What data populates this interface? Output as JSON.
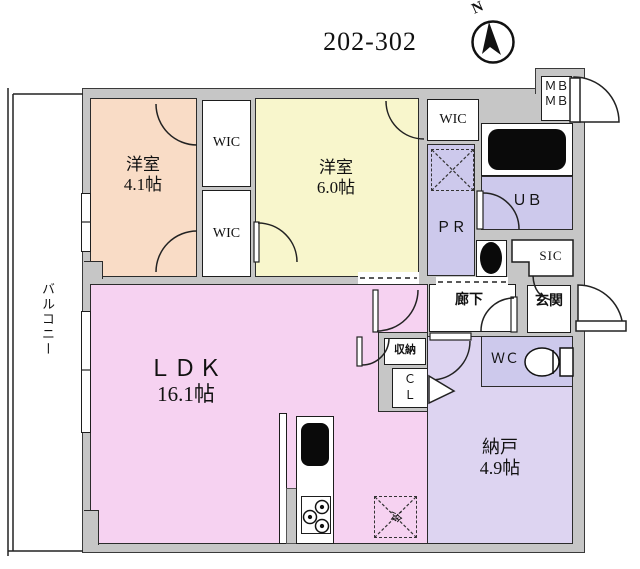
{
  "title": "202-302",
  "compass": {
    "north": "N"
  },
  "balcony": {
    "label": "バルコニー"
  },
  "rooms": {
    "west1": {
      "name": "洋室",
      "size": "4.1帖"
    },
    "west2": {
      "name": "洋室",
      "size": "6.0帖"
    },
    "ldk": {
      "name": "ＬＤＫ",
      "size": "16.1帖"
    },
    "nando": {
      "name": "納戸",
      "size": "4.9帖"
    },
    "hallway": {
      "label": "廊下"
    },
    "entrance": {
      "label": "玄関"
    },
    "wc": {
      "label": "ＷＣ"
    },
    "ub": {
      "label": "ＵＢ"
    },
    "pr": {
      "label": "ＰＲ"
    },
    "sic": {
      "label": "SIC"
    },
    "wic": {
      "label": "WIC"
    },
    "mb": {
      "label": "ＭＢ"
    },
    "storage": {
      "label": "収納"
    },
    "closet": {
      "c": "Ｃ",
      "l": "Ｌ"
    },
    "fridge": {
      "label": "冷"
    }
  },
  "colors": {
    "wall_gray": "#c6c6c6",
    "west_room_1": "#f9dcc6",
    "west_room_2": "#f8f6cc",
    "ldk_pink": "#f6d2f1",
    "nando_purple": "#ddd4f1",
    "wet_area_lavender": "#cdc9ec",
    "outline": "#2b2b2b"
  }
}
